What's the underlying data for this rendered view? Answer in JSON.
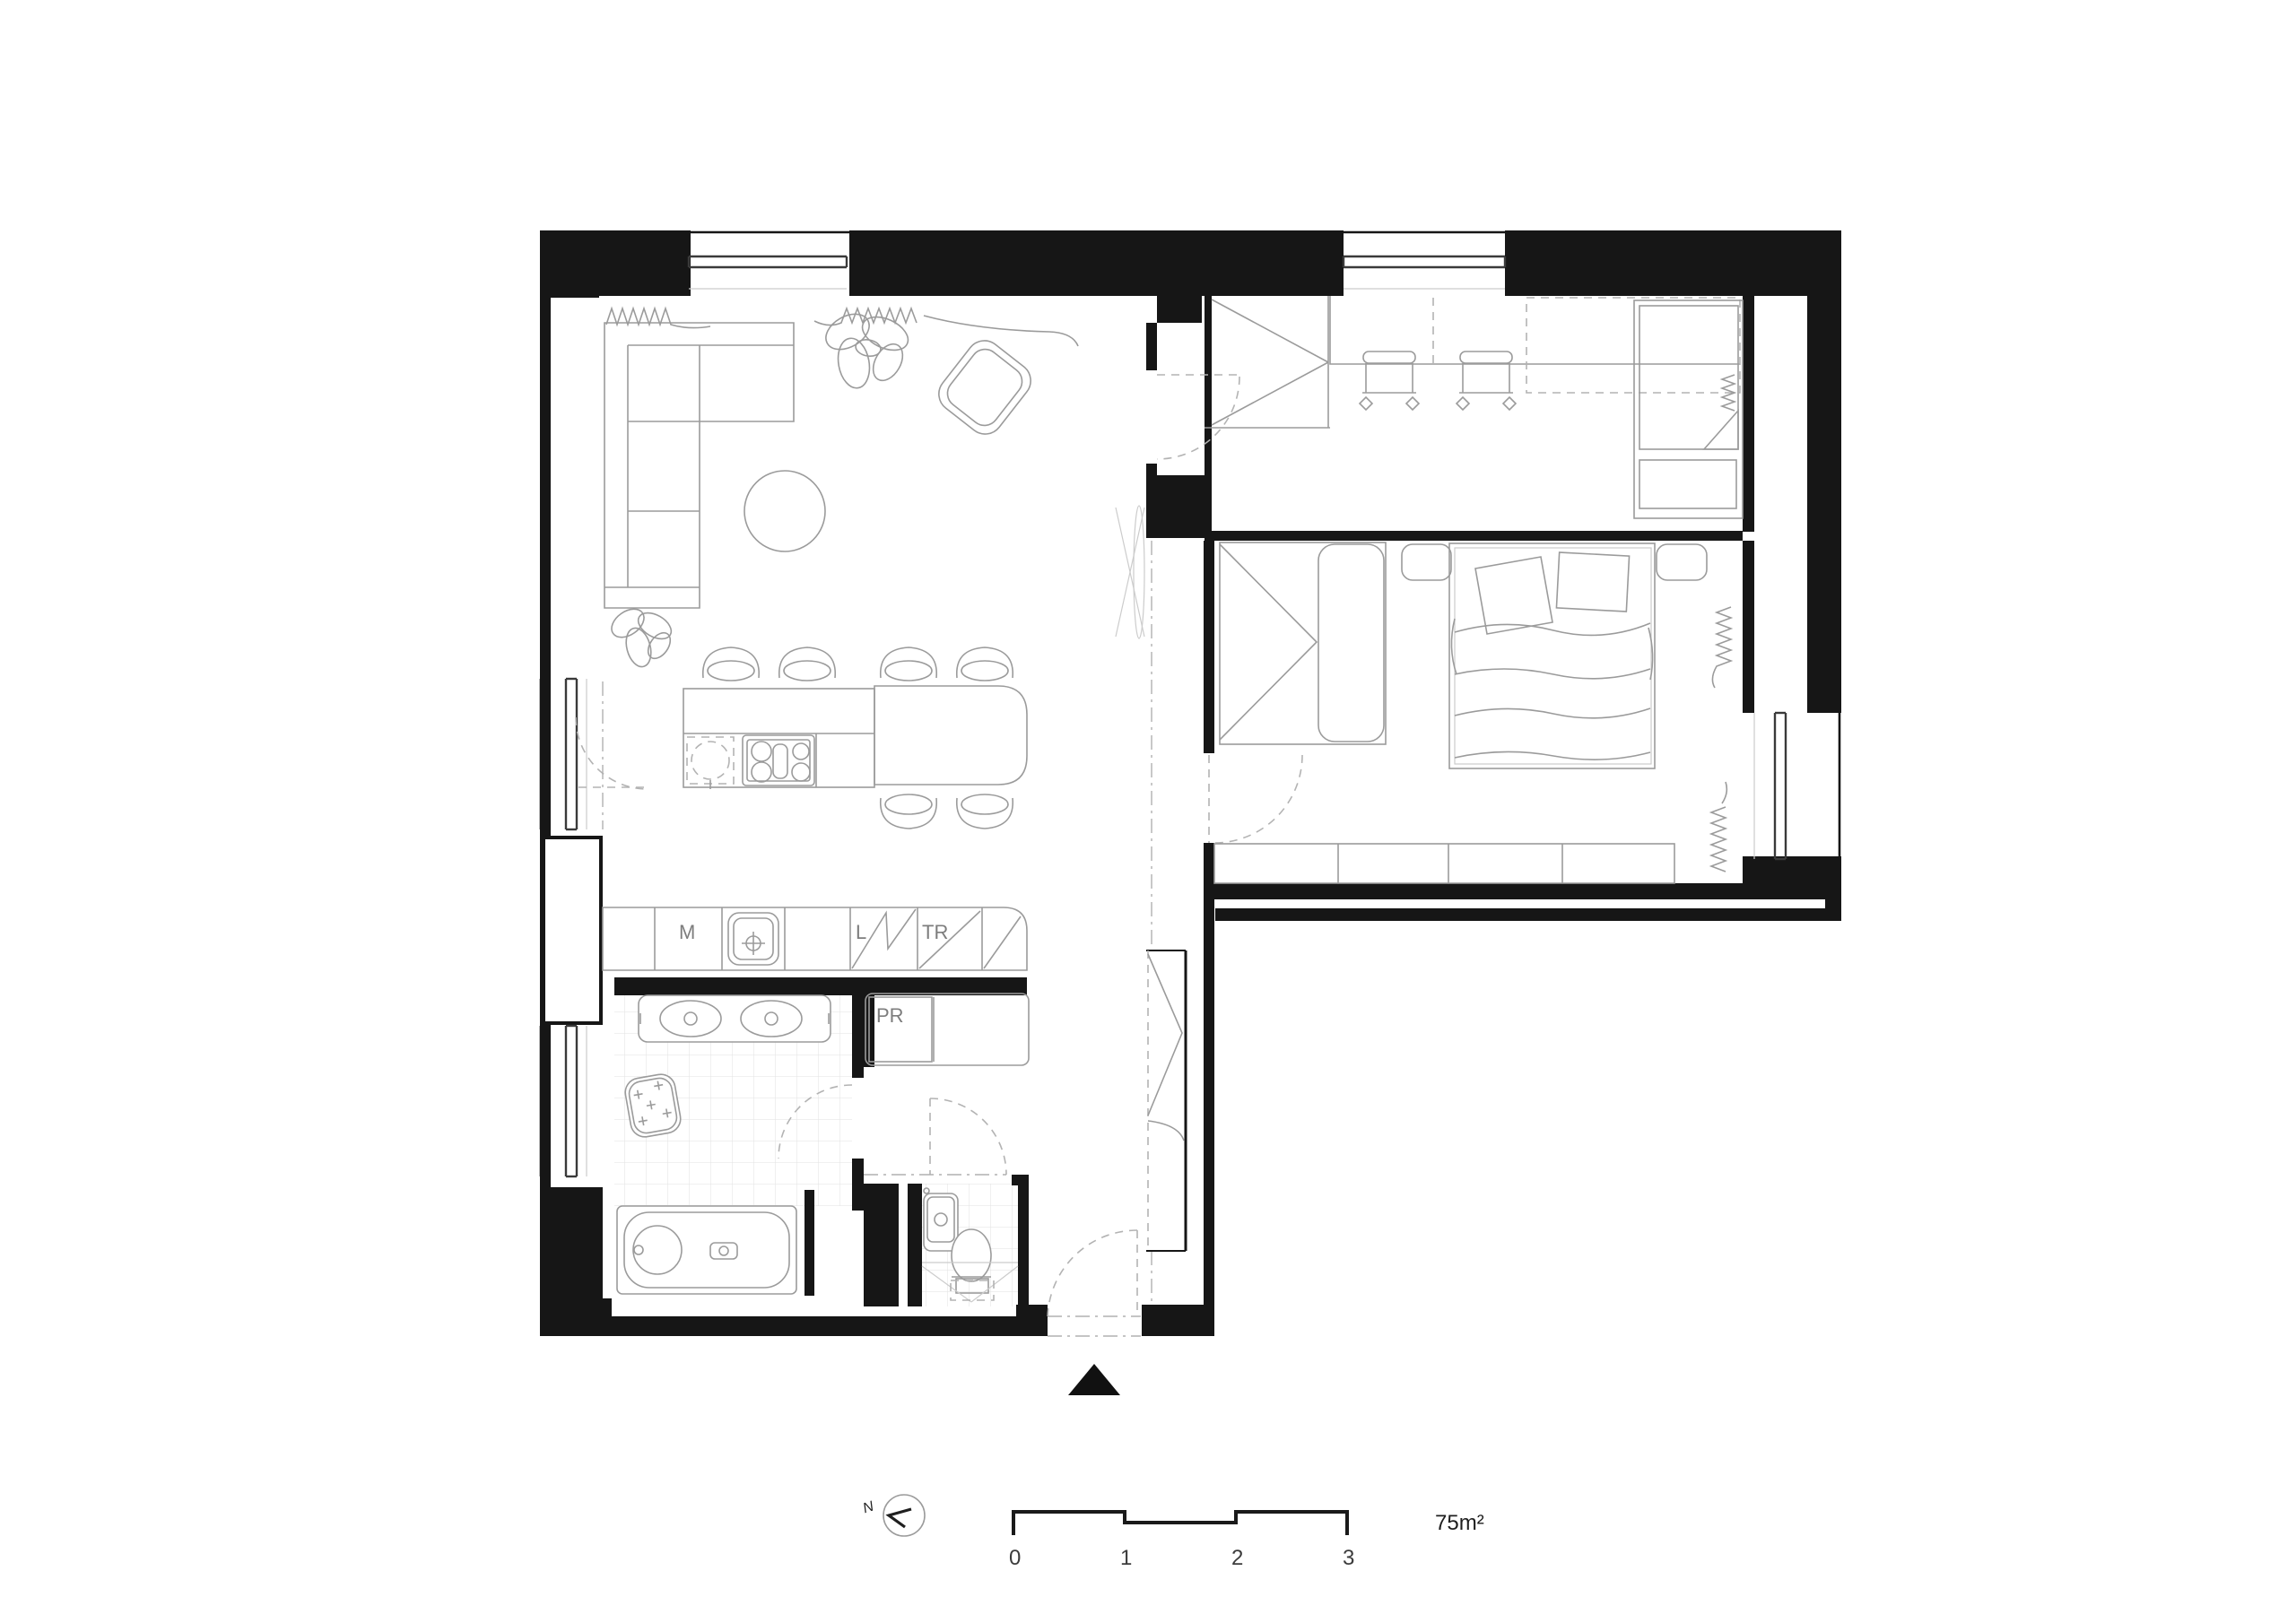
{
  "title": "apartment-floor-plan",
  "labels": {
    "m": "M",
    "l": "L",
    "tr": "TR",
    "pr": "PR"
  },
  "legend": {
    "north": "N",
    "area": "75m²",
    "scale_ticks": [
      "0",
      "1",
      "2",
      "3"
    ]
  },
  "colors": {
    "wall": "#161616",
    "furniture_line": "#9b9b9b",
    "dashed_line": "#b3b3b3",
    "tile_line": "#e0e0e0",
    "label_text": "#7d7d7d",
    "dark_text": "#1f1f1f",
    "background": "#ffffff"
  }
}
